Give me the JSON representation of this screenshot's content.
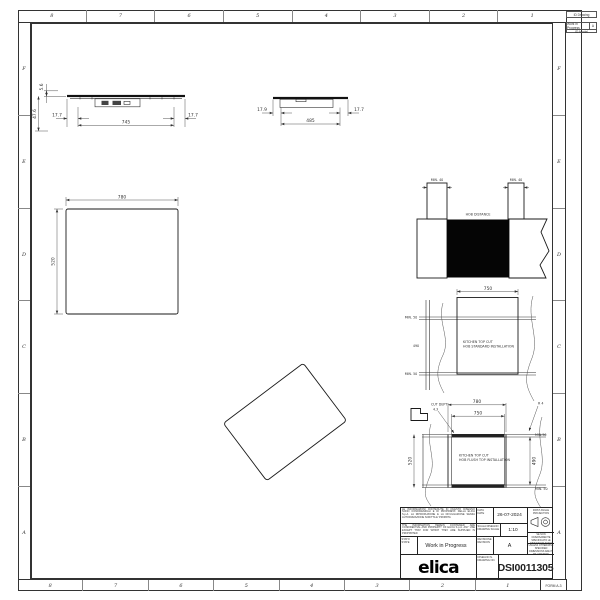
{
  "sheet": {
    "columns": [
      "8",
      "7",
      "6",
      "5",
      "4",
      "3",
      "2",
      "1"
    ],
    "rows": [
      "F",
      "E",
      "D",
      "C",
      "B",
      "A"
    ],
    "form": "FORM A-3",
    "corner": {
      "box1": "ID Drawing",
      "state": "Work in Progress",
      "state_rev": "A",
      "box2": "ID Model"
    }
  },
  "views": {
    "front_section": {
      "glass_thickness": "5.6",
      "total_height": "47.6",
      "left_offset": "17.7",
      "body_width": "745",
      "right_offset": "17.7"
    },
    "depth_section": {
      "left_offset": "17.9",
      "body_depth": "485",
      "right_offset": "17.7"
    },
    "top_view": {
      "width": "780",
      "depth": "520"
    },
    "wall_clearance": {
      "min_left": "MIN. 40",
      "min_right": "MIN. 40",
      "hob_distance": "HOB DISTANCE"
    },
    "standard_cut": {
      "cut_width": "750",
      "min_back": "MIN. 50",
      "cut_depth": "490",
      "min_front": "MIN. 50",
      "caption1": "KITCHEN TOP CUT",
      "caption2": "HOB STANDARD INSTALLATION"
    },
    "flush_cut": {
      "cut_dept_label": "CUT DEPT",
      "cut_dept_value": "4.3",
      "recess_width": "780",
      "cut_width": "750",
      "recess_depth": "520",
      "cut_depth": "490",
      "min_back": "MIN.50",
      "min_front": "MIN. 50",
      "corner_radius": "R 4",
      "caption1": "KITCHEN TOP CUT",
      "caption2": "HOB FLUSH TOP INSTALLATION"
    }
  },
  "title_block": {
    "legal_it": "LE INFORMAZIONI CONTENUTE IN QUESTO DISEGNO SONO CONFIDENZIALI E DI PROPRIETA' DELLA ELICA S.p.A. LA RIPRODUZIONE E LA DIVULGAZIONE SENZA AUTORIZZAZIONE SCRITTA E' PROIBITA",
    "legal_en": "THE INFORMATION HEREIN CONTAINED ARE CONFIDENTIAL AND PROPERTY OF ELICA S.p.A. ANY USE EXCEPT THAT FOR WHICH THEY ARE SUPPLIED IS PROHIBITED",
    "labels": {
      "stato": "STATO",
      "state": "STATE",
      "data": "DATA",
      "date": "DATE",
      "scala": "SCALA DISEGNO",
      "scale": "DRAWING SCALE",
      "revisione": "REVISIONE",
      "revision": "REVISION",
      "disegno": "DISEGNO N.",
      "drawing_no": "DRAWING NO."
    },
    "state_value": "Work in Progress",
    "date_value": "26-07-2024",
    "scale_value": "1:10",
    "revision_value": "A",
    "drawing_number": "DSI0011305",
    "logo": "elica",
    "projection": "FIRST ANGLE PROJECTION",
    "note_it": "SE NON DIVERSAMENTE SPECIFICATO LE DIMENSIONI SONO ESPRESSE IN MILLIMETRI",
    "note_en": "UNLESS OTHERWISE SPECIFIED DIMENSIONS ARE IN MILLIMETERS"
  }
}
